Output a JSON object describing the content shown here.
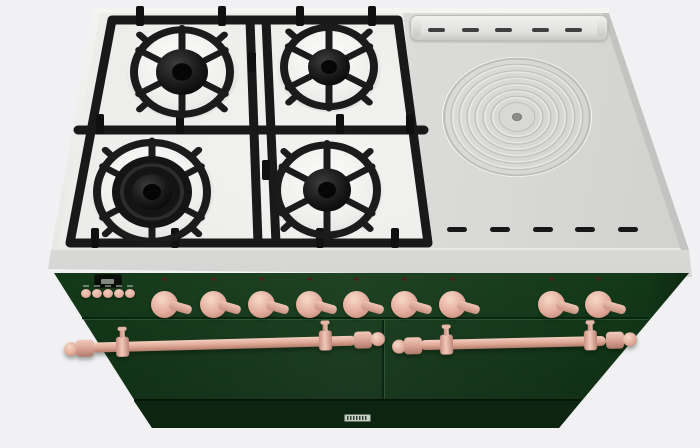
{
  "meta": {
    "description": "3D product render of a freestanding range cooker: dark green body, copper knobs and towel-rail door handles, four-burner gas hob with black cast-iron grates on the left and a stainless hot plate with round simmer ring on the right"
  },
  "colors": {
    "bg": "#f1f1f3",
    "steel": "#dcdcda",
    "steel_light": "#efefed",
    "steel_dark": "#c3c3c1",
    "enamel": "#ebebe9",
    "grate": "#1a1a1a",
    "green": "#17431f",
    "green_light": "#215730",
    "green_dark": "#0d2a12",
    "copper": "#e2af9f",
    "copper_light": "#f3ccbd",
    "copper_dark": "#bb8274",
    "slot": "#171717",
    "display_bg": "#0a0d0a"
  },
  "cooktop": {
    "gas_burners": {
      "count": 4,
      "layout": "2x2",
      "grates": "cast-iron"
    },
    "simmer_plate": {
      "shape": "round",
      "concentric_rings": true
    },
    "back_vent_slot_count": 5,
    "front_vent_slot_count": 5
  },
  "control_panel": {
    "clock_display": {
      "present": true,
      "legible": false
    },
    "small_button_count": 5,
    "knob_count": 9,
    "knob_finish": "copper"
  },
  "doors": {
    "count": 2,
    "handle_rails": 2,
    "rail_finish": "copper"
  },
  "badge": {
    "present": true,
    "legible": false
  },
  "layout": {
    "knob_xs": [
      163,
      212,
      260,
      308,
      355,
      403,
      451,
      550,
      597
    ],
    "knob_y": 276,
    "button_xs": [
      86,
      97,
      108,
      119,
      130
    ],
    "button_y": 289,
    "top_slot_xs": [
      18,
      52,
      85,
      122,
      155
    ],
    "front_slot_xs": [
      447,
      490,
      533,
      575,
      618
    ],
    "front_slot_y": 227
  }
}
